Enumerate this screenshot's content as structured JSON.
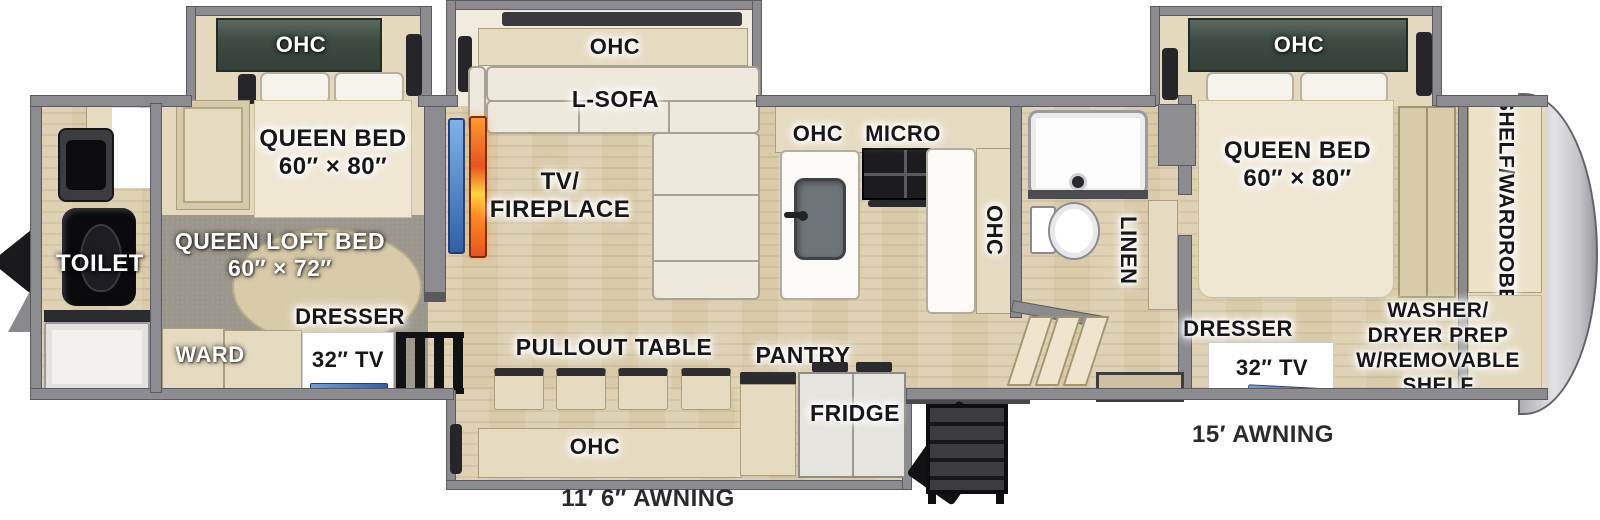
{
  "diagram_type": "rv-fifth-wheel-floorplan",
  "labels": {
    "rear_bath": {
      "toilet": "TOILET"
    },
    "rear_bedroom": {
      "ohc": "OHC",
      "bed_line1": "QUEEN BED",
      "bed_line2": "60″ × 80″",
      "loft_line1": "QUEEN LOFT BED",
      "loft_line2": "60″ × 72″",
      "dresser": "DRESSER",
      "tv": "32″ TV",
      "ward": "WARD"
    },
    "living": {
      "ohc": "OHC",
      "sofa": "L-SOFA",
      "tv_fireplace_line1": "TV/",
      "tv_fireplace_line2": "FIREPLACE"
    },
    "dinette": {
      "pullout_table": "PULLOUT TABLE",
      "ohc": "OHC",
      "pantry": "PANTRY",
      "fridge": "FRIDGE"
    },
    "kitchen": {
      "ohc": "OHC",
      "micro": "MICRO",
      "ohc_side": "OHC"
    },
    "bathroom": {
      "linen": "LINEN"
    },
    "front_bedroom": {
      "ohc": "OHC",
      "bed_line1": "QUEEN BED",
      "bed_line2": "60″ × 80″",
      "wardrobe_line1": "SHELF/",
      "wardrobe_line2": "WARDROBE",
      "washer_line1": "WASHER/",
      "washer_line2": "DRYER PREP",
      "washer_line3": "W/REMOVABLE",
      "washer_line4": "SHELF",
      "dresser": "DRESSER",
      "tv": "32″ TV"
    },
    "awnings": {
      "door_side": "11′ 6″ AWNING",
      "front": "15′ AWNING"
    }
  },
  "colors": {
    "wall": "#8c8c90",
    "wood_floor": "#d9cbaa",
    "carpet": "#9c978d",
    "cabinet_green": "#3e4c43",
    "fireplace_orange": "#e8531f",
    "tv_blue": "#3f6fb5",
    "front_cap_gray": "#c7c7ca"
  }
}
